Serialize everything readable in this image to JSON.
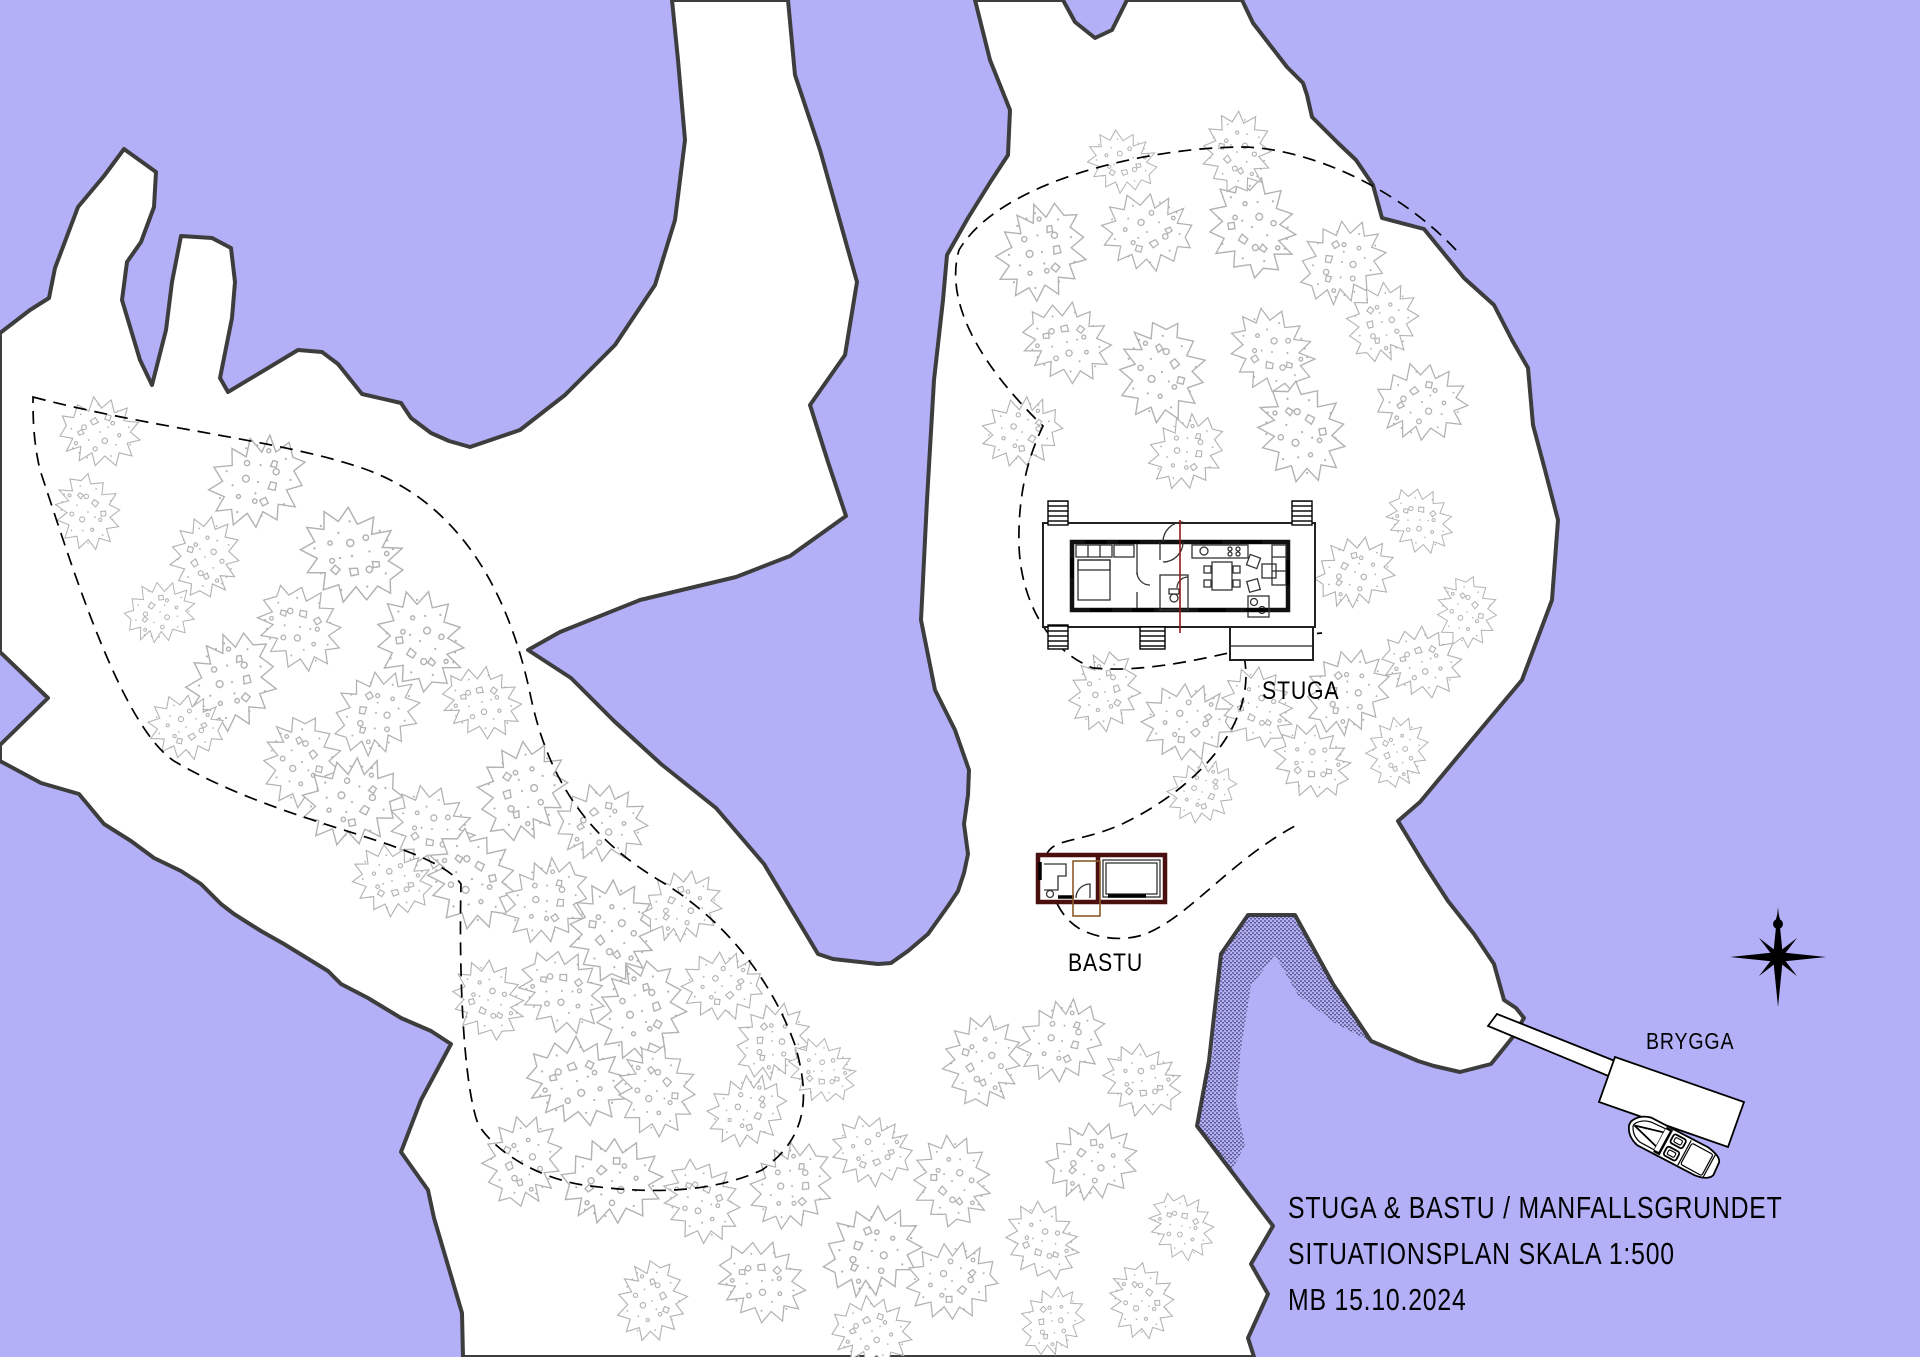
{
  "title_block": {
    "line1": "STUGA & BASTU / MANFALLSGRUNDET",
    "line2": "SITUATIONSPLAN SKALA 1:500",
    "line3": "MB 15.10.2024"
  },
  "labels": {
    "stuga": "STUGA",
    "bastu": "BASTU",
    "brygga": "BRYGGA"
  },
  "colors": {
    "water": "#b3b0f8",
    "land": "#ffffff",
    "coast": "#3d3d3d",
    "tree": "#b2b2b2",
    "bastu_wall": "#4a0f0f",
    "terrace": "#8a5a2a",
    "section_line": "#8b1a1a",
    "path": "#000000",
    "text": "#000000"
  },
  "map": {
    "scale_text": "1:500",
    "trees": [
      {
        "x": 100,
        "y": 432,
        "s": 0.8
      },
      {
        "x": 88,
        "y": 512,
        "s": 0.75
      },
      {
        "x": 258,
        "y": 482,
        "s": 1
      },
      {
        "x": 352,
        "y": 556,
        "s": 1.05
      },
      {
        "x": 205,
        "y": 557,
        "s": 0.8
      },
      {
        "x": 160,
        "y": 612,
        "s": 0.7
      },
      {
        "x": 300,
        "y": 627,
        "s": 0.9
      },
      {
        "x": 232,
        "y": 682,
        "s": 1
      },
      {
        "x": 186,
        "y": 727,
        "s": 0.75
      },
      {
        "x": 420,
        "y": 641,
        "s": 1
      },
      {
        "x": 376,
        "y": 713,
        "s": 0.9
      },
      {
        "x": 482,
        "y": 702,
        "s": 0.8
      },
      {
        "x": 302,
        "y": 762,
        "s": 0.9
      },
      {
        "x": 352,
        "y": 802,
        "s": 1
      },
      {
        "x": 432,
        "y": 829,
        "s": 0.9
      },
      {
        "x": 522,
        "y": 791,
        "s": 1
      },
      {
        "x": 602,
        "y": 823,
        "s": 0.9
      },
      {
        "x": 472,
        "y": 879,
        "s": 1
      },
      {
        "x": 547,
        "y": 901,
        "s": 0.9
      },
      {
        "x": 392,
        "y": 881,
        "s": 0.8
      },
      {
        "x": 612,
        "y": 931,
        "s": 1
      },
      {
        "x": 682,
        "y": 906,
        "s": 0.8
      },
      {
        "x": 562,
        "y": 991,
        "s": 0.9
      },
      {
        "x": 642,
        "y": 1011,
        "s": 1
      },
      {
        "x": 722,
        "y": 986,
        "s": 0.8
      },
      {
        "x": 488,
        "y": 1000,
        "s": 0.8
      },
      {
        "x": 772,
        "y": 1041,
        "s": 0.8
      },
      {
        "x": 577,
        "y": 1081,
        "s": 1
      },
      {
        "x": 657,
        "y": 1091,
        "s": 0.9
      },
      {
        "x": 747,
        "y": 1111,
        "s": 0.8
      },
      {
        "x": 822,
        "y": 1071,
        "s": 0.7
      },
      {
        "x": 522,
        "y": 1161,
        "s": 0.9
      },
      {
        "x": 612,
        "y": 1181,
        "s": 1
      },
      {
        "x": 702,
        "y": 1201,
        "s": 0.85
      },
      {
        "x": 792,
        "y": 1186,
        "s": 0.9
      },
      {
        "x": 872,
        "y": 1151,
        "s": 0.8
      },
      {
        "x": 952,
        "y": 1181,
        "s": 0.9
      },
      {
        "x": 872,
        "y": 1251,
        "s": 1
      },
      {
        "x": 762,
        "y": 1281,
        "s": 0.9
      },
      {
        "x": 652,
        "y": 1301,
        "s": 0.8
      },
      {
        "x": 952,
        "y": 1281,
        "s": 0.9
      },
      {
        "x": 1042,
        "y": 1241,
        "s": 0.8
      },
      {
        "x": 1052,
        "y": 1321,
        "s": 0.7
      },
      {
        "x": 872,
        "y": 1331,
        "s": 0.8
      },
      {
        "x": 1142,
        "y": 1301,
        "s": 0.75
      },
      {
        "x": 1062,
        "y": 1041,
        "s": 0.9
      },
      {
        "x": 1142,
        "y": 1081,
        "s": 0.8
      },
      {
        "x": 982,
        "y": 1061,
        "s": 0.9
      },
      {
        "x": 1092,
        "y": 1161,
        "s": 0.9
      },
      {
        "x": 1182,
        "y": 1226,
        "s": 0.7
      },
      {
        "x": 1042,
        "y": 252,
        "s": 1
      },
      {
        "x": 1147,
        "y": 232,
        "s": 0.9
      },
      {
        "x": 1252,
        "y": 227,
        "s": 1
      },
      {
        "x": 1342,
        "y": 262,
        "s": 0.9
      },
      {
        "x": 1067,
        "y": 342,
        "s": 0.9
      },
      {
        "x": 1162,
        "y": 372,
        "s": 1
      },
      {
        "x": 1022,
        "y": 432,
        "s": 0.8
      },
      {
        "x": 1272,
        "y": 352,
        "s": 0.9
      },
      {
        "x": 1382,
        "y": 322,
        "s": 0.8
      },
      {
        "x": 1422,
        "y": 402,
        "s": 0.9
      },
      {
        "x": 1302,
        "y": 432,
        "s": 1
      },
      {
        "x": 1187,
        "y": 452,
        "s": 0.8
      },
      {
        "x": 1122,
        "y": 162,
        "s": 0.7
      },
      {
        "x": 1237,
        "y": 152,
        "s": 0.8
      },
      {
        "x": 1355,
        "y": 572,
        "s": 0.8
      },
      {
        "x": 1420,
        "y": 520,
        "s": 0.7
      },
      {
        "x": 1105,
        "y": 692,
        "s": 0.8
      },
      {
        "x": 1187,
        "y": 722,
        "s": 0.9
      },
      {
        "x": 1257,
        "y": 707,
        "s": 0.8
      },
      {
        "x": 1347,
        "y": 692,
        "s": 0.9
      },
      {
        "x": 1422,
        "y": 662,
        "s": 0.8
      },
      {
        "x": 1467,
        "y": 612,
        "s": 0.7
      },
      {
        "x": 1202,
        "y": 792,
        "s": 0.7
      },
      {
        "x": 1312,
        "y": 762,
        "s": 0.8
      },
      {
        "x": 1397,
        "y": 752,
        "s": 0.7
      }
    ]
  }
}
